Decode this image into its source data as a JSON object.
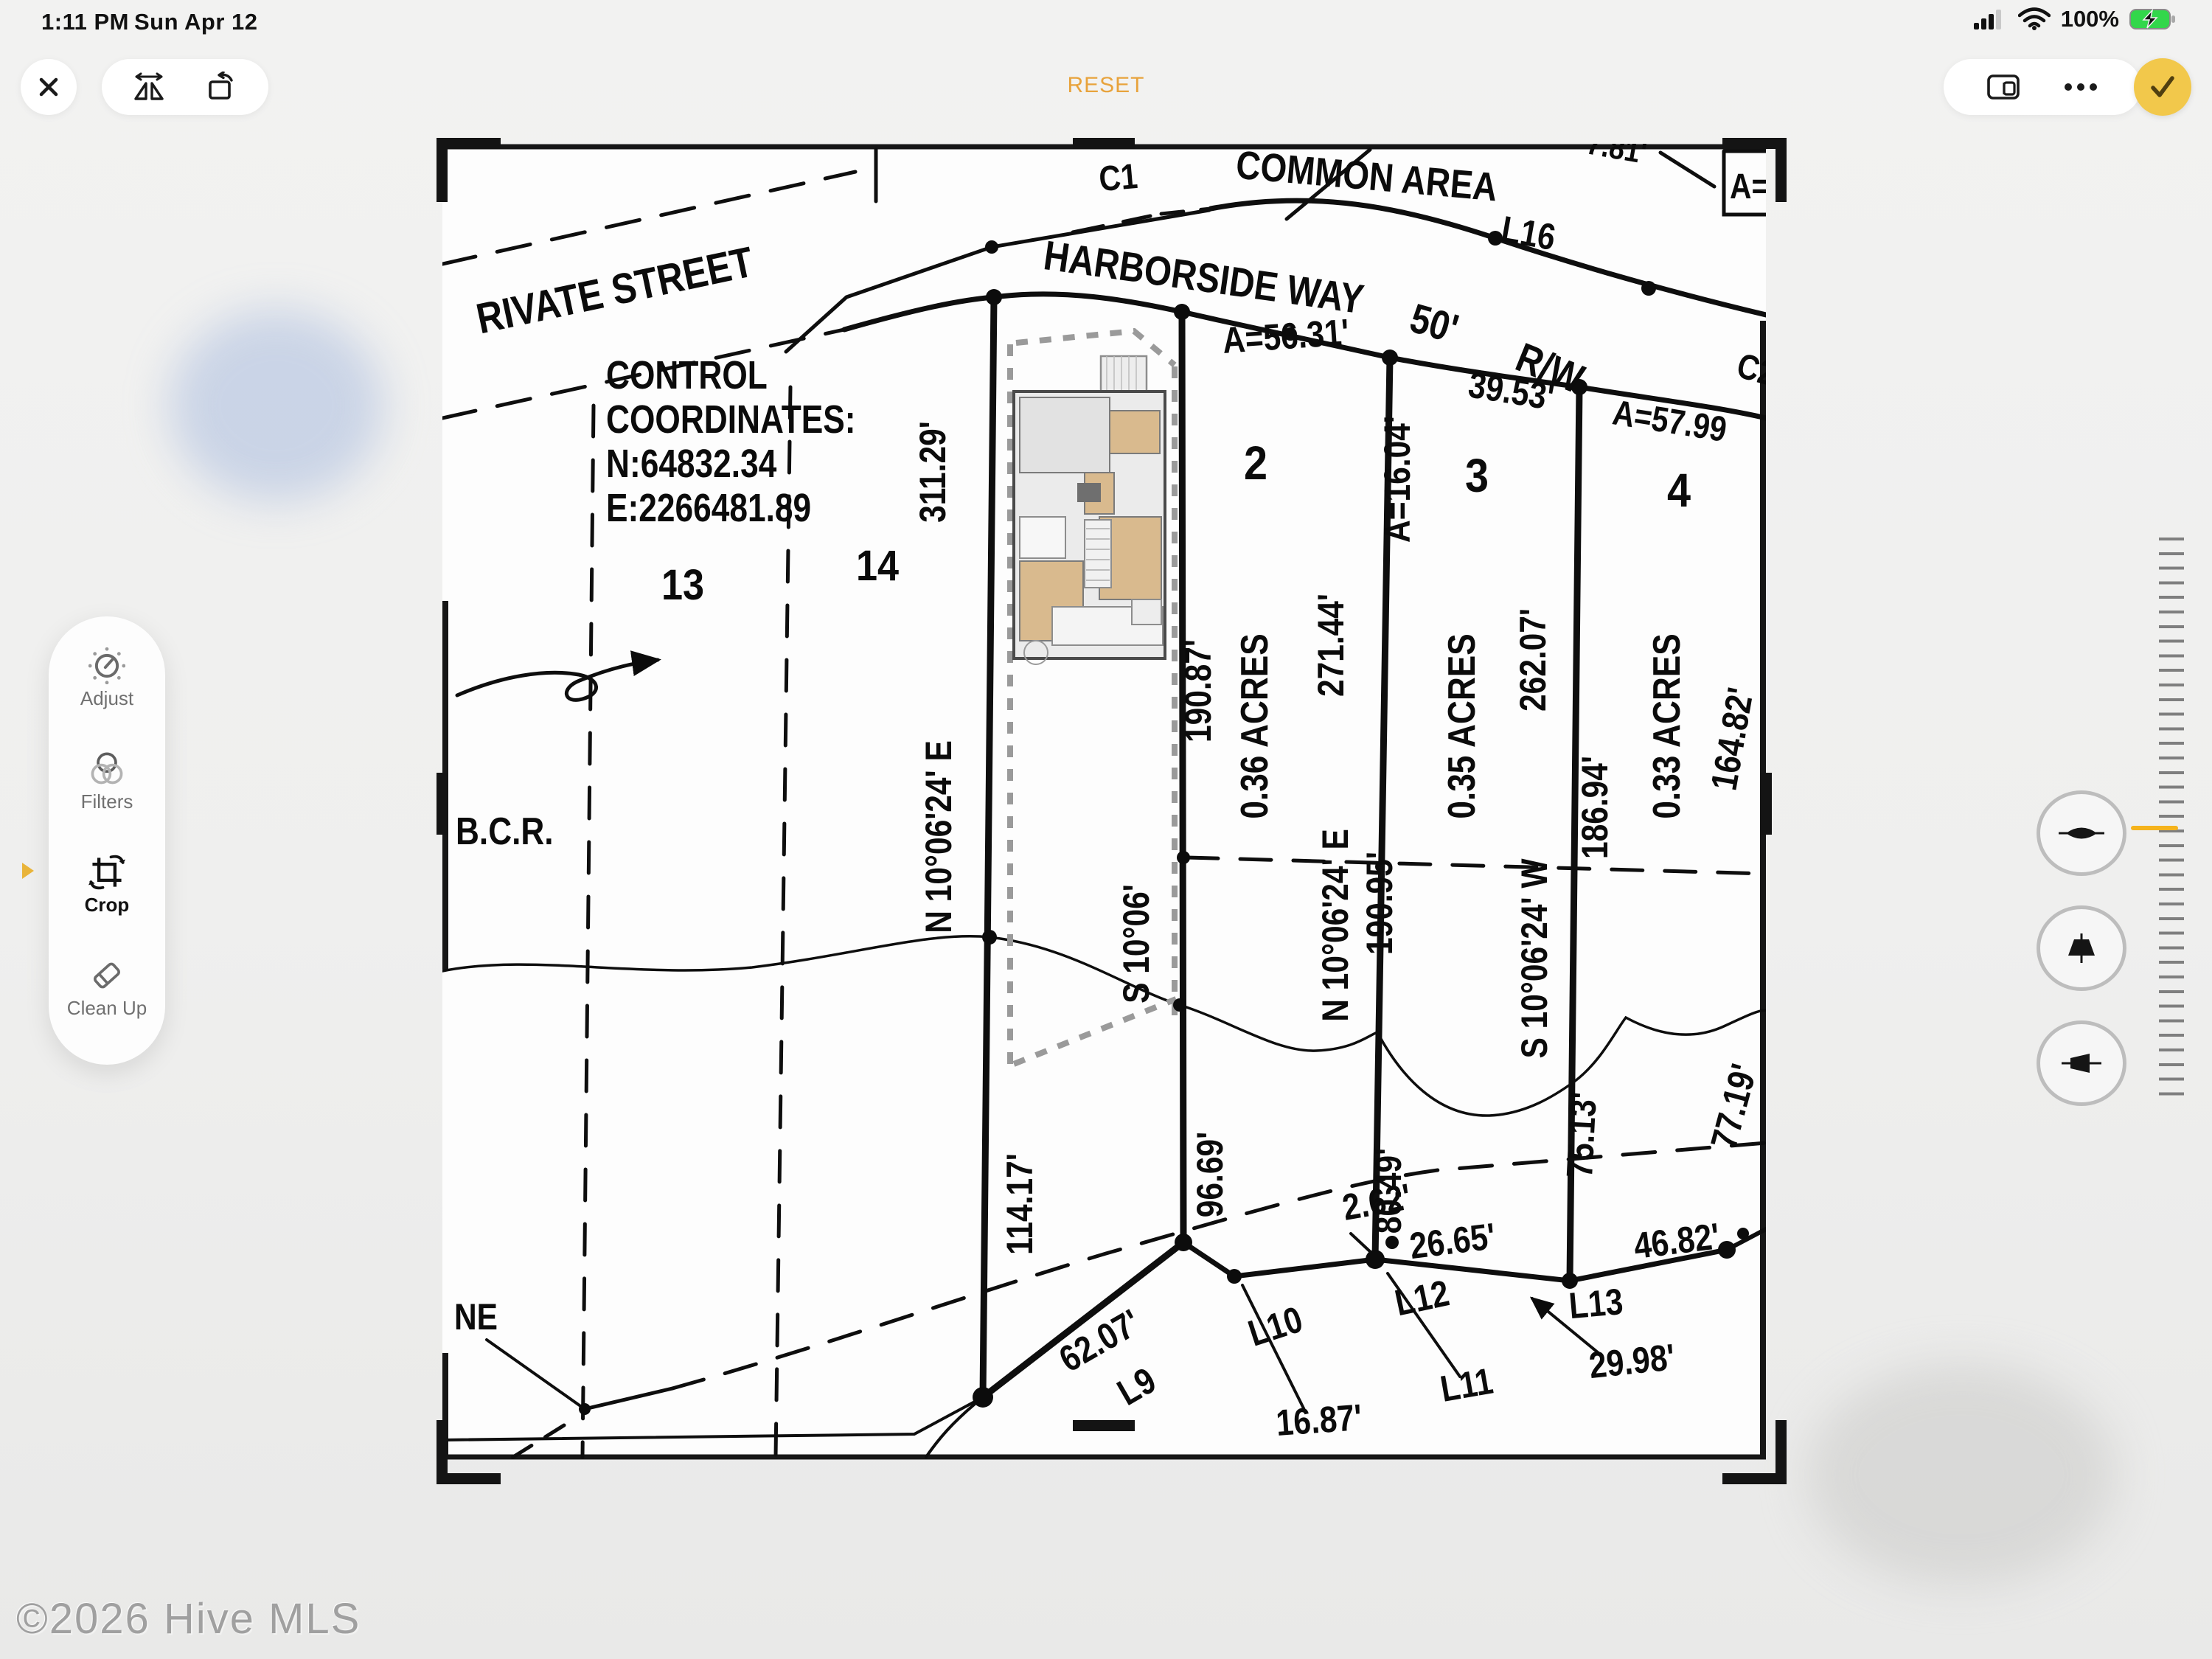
{
  "status_bar": {
    "time": "1:11 PM",
    "date": "Sun Apr 12",
    "battery_percent": "100%"
  },
  "toolbar": {
    "reset_label": "RESET"
  },
  "sidebar": {
    "items": [
      {
        "label": "Adjust",
        "active": false
      },
      {
        "label": "Filters",
        "active": false
      },
      {
        "label": "Crop",
        "active": true
      },
      {
        "label": "Clean Up",
        "active": false
      }
    ]
  },
  "watermark": "©2026 Hive MLS",
  "colors": {
    "accent_yellow": "#F2C84B",
    "reset_orange": "#E8A33C",
    "battery_green": "#32D74B",
    "dial_indicator": "#F5B31C"
  },
  "map": {
    "labels": {
      "rivate_street": "RIVATE STREET",
      "harborside_way": "HARBORSIDE WAY",
      "rw_50": "50'",
      "rw": "R/W",
      "common_area": "COMMON AREA",
      "c1": "C1",
      "c2": "C2",
      "l16": "L16",
      "len_781": "7.81'",
      "a_eq_2": "A=2",
      "a_5631": "A=56.31'",
      "len_3953": "39.53'",
      "a_5799": "A=57.99",
      "a_1604": "A=16.04'",
      "lot_13": "13",
      "lot_14": "14",
      "lot_2": "2",
      "lot_3": "3",
      "lot_4": "4",
      "bcr": "B.C.R.",
      "ne": "NE",
      "control_line1": "CONTROL",
      "control_line2": "COORDINATES:",
      "control_line3": "N:64832.34",
      "control_line4": "E:2266481.89",
      "len_31129": "311.29'",
      "bearing_a": "N 10°06'24' E",
      "len_11417": "114.17'",
      "bearing_b": "S 10°06'",
      "len_19087": "190.87'",
      "acres_2": "0.36 ACRES",
      "len_9669": "96.69'",
      "len_27144": "271.44'",
      "bearing_c": "N 10°06'24' E",
      "len_19095": "190.95'",
      "len_8049": "80.49'",
      "acres_3": "0.35 ACRES",
      "len_26207": "262.07'",
      "bearing_d": "S 10°06'24' W",
      "len_7513": "75.13'",
      "len_18694": "186.94'",
      "acres_4": "0.33 ACRES",
      "len_16482": "164.82'",
      "len_7719": "77.19'",
      "len_262": "2.62'",
      "len_2665": "26.65'",
      "len_6207": "62.07'",
      "l9": "L9",
      "l10": "L10",
      "l11": "L11",
      "l12": "L12",
      "l13": "L13",
      "len_1687": "16.87'",
      "len_2998": "29.98'",
      "len_4682": "46.82'"
    }
  }
}
